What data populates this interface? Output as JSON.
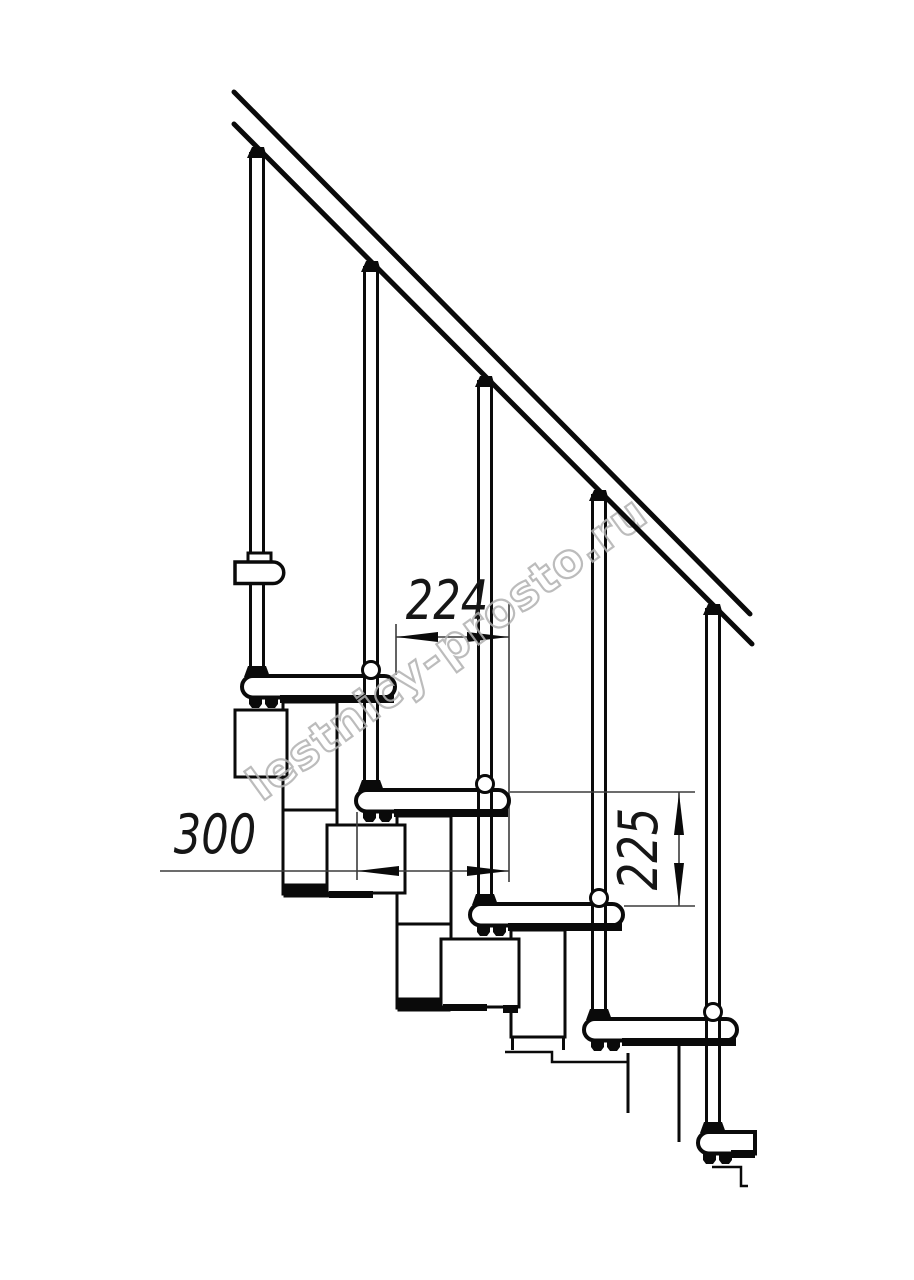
{
  "drawing": {
    "title": "modular-staircase-side-view",
    "dimensions": {
      "run_224": "224",
      "depth_300": "300",
      "rise_225": "225"
    },
    "watermark": "lestnicy-prosto.ru",
    "colors": {
      "line": "#0a0a0a",
      "dim_line": "#3c3c3c",
      "watermark": "#b1b1b1",
      "background": "#ffffff"
    }
  }
}
